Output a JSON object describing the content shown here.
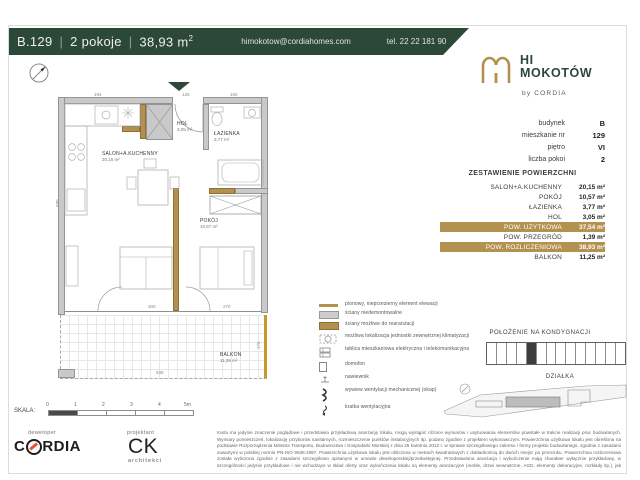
{
  "header": {
    "unit": "B.129",
    "sep": "|",
    "rooms": "2 pokoje",
    "area": "38,93 m",
    "area_sup": "2",
    "email": "himokotow@cordiahomes.com",
    "phone": "tel. 22 22 181 90"
  },
  "brand": {
    "line1": "HI",
    "line2": "MOKOTÓW",
    "byline": "by CORDIA"
  },
  "details": {
    "rows": [
      {
        "label": "budynek",
        "value": "B"
      },
      {
        "label": "mieszkanie nr",
        "value": "129"
      },
      {
        "label": "piętro",
        "value": "VI"
      },
      {
        "label": "liczba pokoi",
        "value": "2"
      }
    ]
  },
  "areas": {
    "title": "ZESTAWIENIE POWIERZCHNI",
    "rows": [
      {
        "label": "SALON+A.KUCHENNY",
        "value": "20,15 m²",
        "highlight": false
      },
      {
        "label": "POKÓJ",
        "value": "10,57 m²",
        "highlight": false
      },
      {
        "label": "ŁAZIENKA",
        "value": "3,77 m²",
        "highlight": false
      },
      {
        "label": "HOL",
        "value": "3,05 m²",
        "highlight": false
      },
      {
        "label": "POW. UŻYTKOWA",
        "value": "37,54 m²",
        "highlight": true
      },
      {
        "label": "POW. PRZEGRÓD",
        "value": "1,39 m²",
        "highlight": false
      },
      {
        "label": "POW. ROZLICZENIOWA",
        "value": "38,93 m²",
        "highlight": true
      },
      {
        "label": "BALKON",
        "value": "11,25 m²",
        "highlight": false
      }
    ]
  },
  "plan": {
    "rooms": {
      "salon": {
        "name": "SALON+A.KUCHENNY",
        "area": "20,15 m²"
      },
      "hol": {
        "name": "HOL",
        "area": "3,05 m²"
      },
      "lazienka": {
        "name": "ŁAZIENKA",
        "area": "3,77 m²"
      },
      "pokoj": {
        "name": "POKÓJ",
        "area": "10,57 m²"
      },
      "balkon": {
        "name": "BALKON",
        "area": "11,25 m²"
      }
    },
    "dims": [
      "194",
      "126",
      "160",
      "590",
      "300",
      "270",
      "638",
      "175"
    ]
  },
  "legend": {
    "items": [
      {
        "icon": "gold-line",
        "label": "pionowy, nieprzezierny element elewacji"
      },
      {
        "icon": "gray-wall",
        "label": "ściany niedemontowalne"
      },
      {
        "icon": "gold-wall",
        "label": "ściany możliwe do rearanżacji"
      },
      {
        "icon": "ac-unit",
        "label": "możliwa lokalizacja jednostki zewnętrznej klimatyzacji"
      },
      {
        "icon": "electrical-board",
        "label": "tablica mieszkaniowa elektryczna i telekomunikacyjna"
      },
      {
        "icon": "intercom",
        "label": "domofon"
      },
      {
        "icon": "air-inlet",
        "label": "nawiewnik"
      },
      {
        "icon": "mech-vent",
        "label": "wywiew wentylacji mechanicznej (okap)"
      },
      {
        "icon": "vent-grille",
        "label": "kratka wentylacyjna"
      }
    ]
  },
  "location": {
    "floor_title": "POŁOŻENIE NA KONDYGNACJI",
    "site_title": "DZIAŁKA"
  },
  "scalebar": {
    "label": "SKALA:",
    "ticks": [
      "0",
      "1",
      "2",
      "3",
      "4",
      "5m"
    ]
  },
  "footer": {
    "developer_label": "deweloper",
    "cordia_c": "C",
    "cordia_rest": "RDIA",
    "designer_label": "projektant",
    "designer_name": "CK",
    "designer_sub": "architekci",
    "disclaimer": "Karta ma jedynie znaczenie poglądowe i przedstawia przykładową aranżację lokalu, mogą wystąpić różnice wymiarów i usytuowania elementów powstałe w trakcie realizacji prac budowlanych. Wymiary pomieszczeń, lokalizację przyborów sanitarnych, rozmieszczenie punktów instalacyjnych itp. podano zgodnie z projektem wykonawczym. Powierzchnia użytkowa lokalu jest określona na podstawie Rozporządzenia Ministra Transportu, Budownictwa i Gospodarki Morskiej z dnia 25 kwietnia 2012 r. w sprawie szczegółowego zakresu i formy projektu budowlanego, zgodnie z zasadami zawartymi w polskiej normie PN-ISO 9836:1997. Powierzchnia użytkowa lokalu jest obliczona w metrach kwadratowych z dokładnością do dwóch miejsc po przecinku. Powierzchnia rozliczeniowa została wyliczona zgodnie z zasadami szczegółowo opisanymi w umowie deweloperskiej/przedwstępnej. Przedstawiona aranżacja i wykończenie mają charakter wyłącznie przykładowy, w szczególności jedynie przykładowe i nie wchodzące w skład oferty oraz wykończenia lokalu są elementy aranżacyjne (meble, drzwi wewnętrzne, AGD, elementy dekoracyjne, rozkłady itp.), jak również bez uwzględnienia grubości tynków, w świetle pionowych przegród (ścian) w stanie surowym. Karta nie stanowi oferty w rozumieniu Kodeksu cywilnego."
  },
  "colors": {
    "green": "#2b4839",
    "gold": "#b3904f",
    "accent_orange": "#e8542e"
  }
}
